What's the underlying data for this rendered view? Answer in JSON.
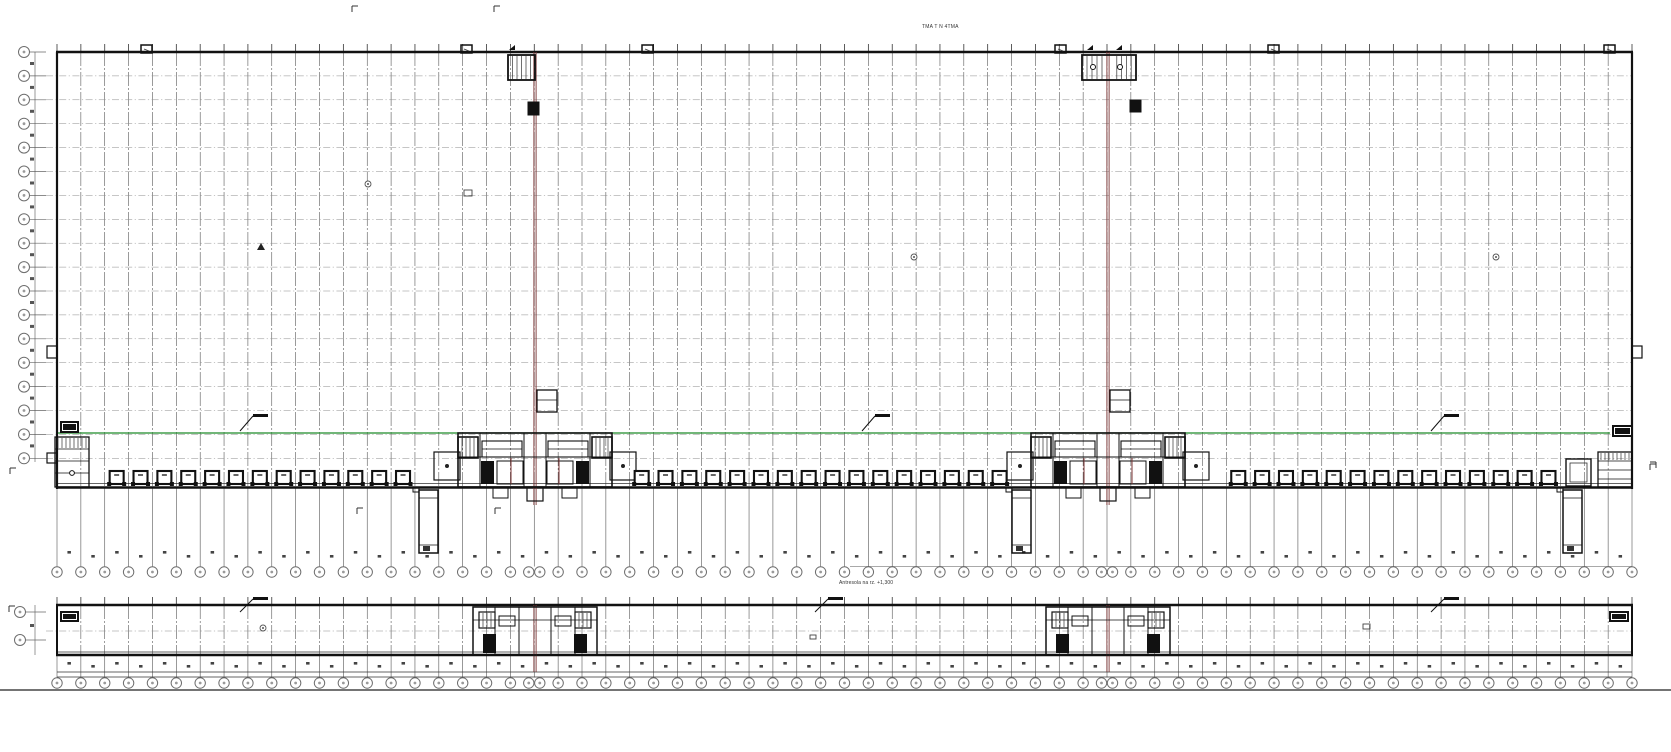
{
  "labels": {
    "top_note": "TMA T N 4TMA",
    "mezzanine_note": "Antresola na rz. +1,300"
  },
  "drawing": {
    "width": 1671,
    "height": 752,
    "colors": {
      "wall": "#111111",
      "grid_v": "#4a4a4a",
      "grid_h": "#8c8c8c",
      "detail": "#222222",
      "dim": "#555555",
      "bubble": "#6e6e6e",
      "bubble_dot": "#9a9a9a",
      "joint_red": "#7b3434",
      "level_green": "#1c8a28",
      "fill_dark": "#111111"
    },
    "main": {
      "x": 57,
      "y": 52,
      "w": 1575,
      "h": 435,
      "cols": 66,
      "row_spacing": 23.9,
      "row_bubbles": 18,
      "bubble_left_x": 24,
      "dim_line_x": 35,
      "grid_below_end": 566.5,
      "bubble_bottom_y": 572,
      "chain_line_y": 566.5,
      "chain_line_x1": 850,
      "sq_row_y": 551
    },
    "joints": [
      535,
      1108
    ],
    "joint_marks": [
      [
        -7,
        102,
        11,
        13
      ],
      [
        22,
        100,
        11,
        12
      ]
    ],
    "green_line": {
      "y": 433,
      "x1": 58,
      "x2": 1610
    },
    "flags_main": [
      253,
      875,
      1444
    ],
    "flags_strip": [
      253,
      1444
    ],
    "center_flag_strip_x": 828,
    "dock_ranges": [
      [
        107,
        417
      ],
      [
        633,
        1002
      ],
      [
        1228,
        1552
      ]
    ],
    "towers": [
      419,
      1012,
      1563
    ],
    "top_markers": [
      146,
      466,
      647,
      1060,
      1273,
      1609
    ],
    "strip": {
      "x": 57,
      "y": 605,
      "w": 1575,
      "h": 50,
      "mid_y": 631,
      "grid_below_end": 677.5,
      "bubble_y": 683,
      "baseline_y": 690,
      "sq_row_y": 662,
      "bubble_left_x": 20,
      "left_bubble_ys": [
        612,
        640
      ]
    },
    "spot_circles": [
      [
        368,
        184
      ],
      [
        914,
        257
      ],
      [
        1496,
        257
      ],
      [
        263,
        628
      ]
    ],
    "spot_rects": [
      [
        464,
        190,
        8,
        6
      ],
      [
        1363,
        624,
        7,
        5
      ],
      [
        810,
        635,
        6,
        4
      ]
    ],
    "spot_triangles": [
      [
        261,
        243
      ]
    ],
    "tiny_marks": [
      [
        352,
        6
      ],
      [
        494,
        6
      ],
      [
        357,
        508
      ],
      [
        495,
        508
      ],
      [
        10,
        468
      ],
      [
        1650,
        464
      ],
      [
        9,
        606
      ]
    ],
    "side_stubs": [
      [
        47,
        346
      ],
      [
        1632,
        346
      ]
    ]
  }
}
